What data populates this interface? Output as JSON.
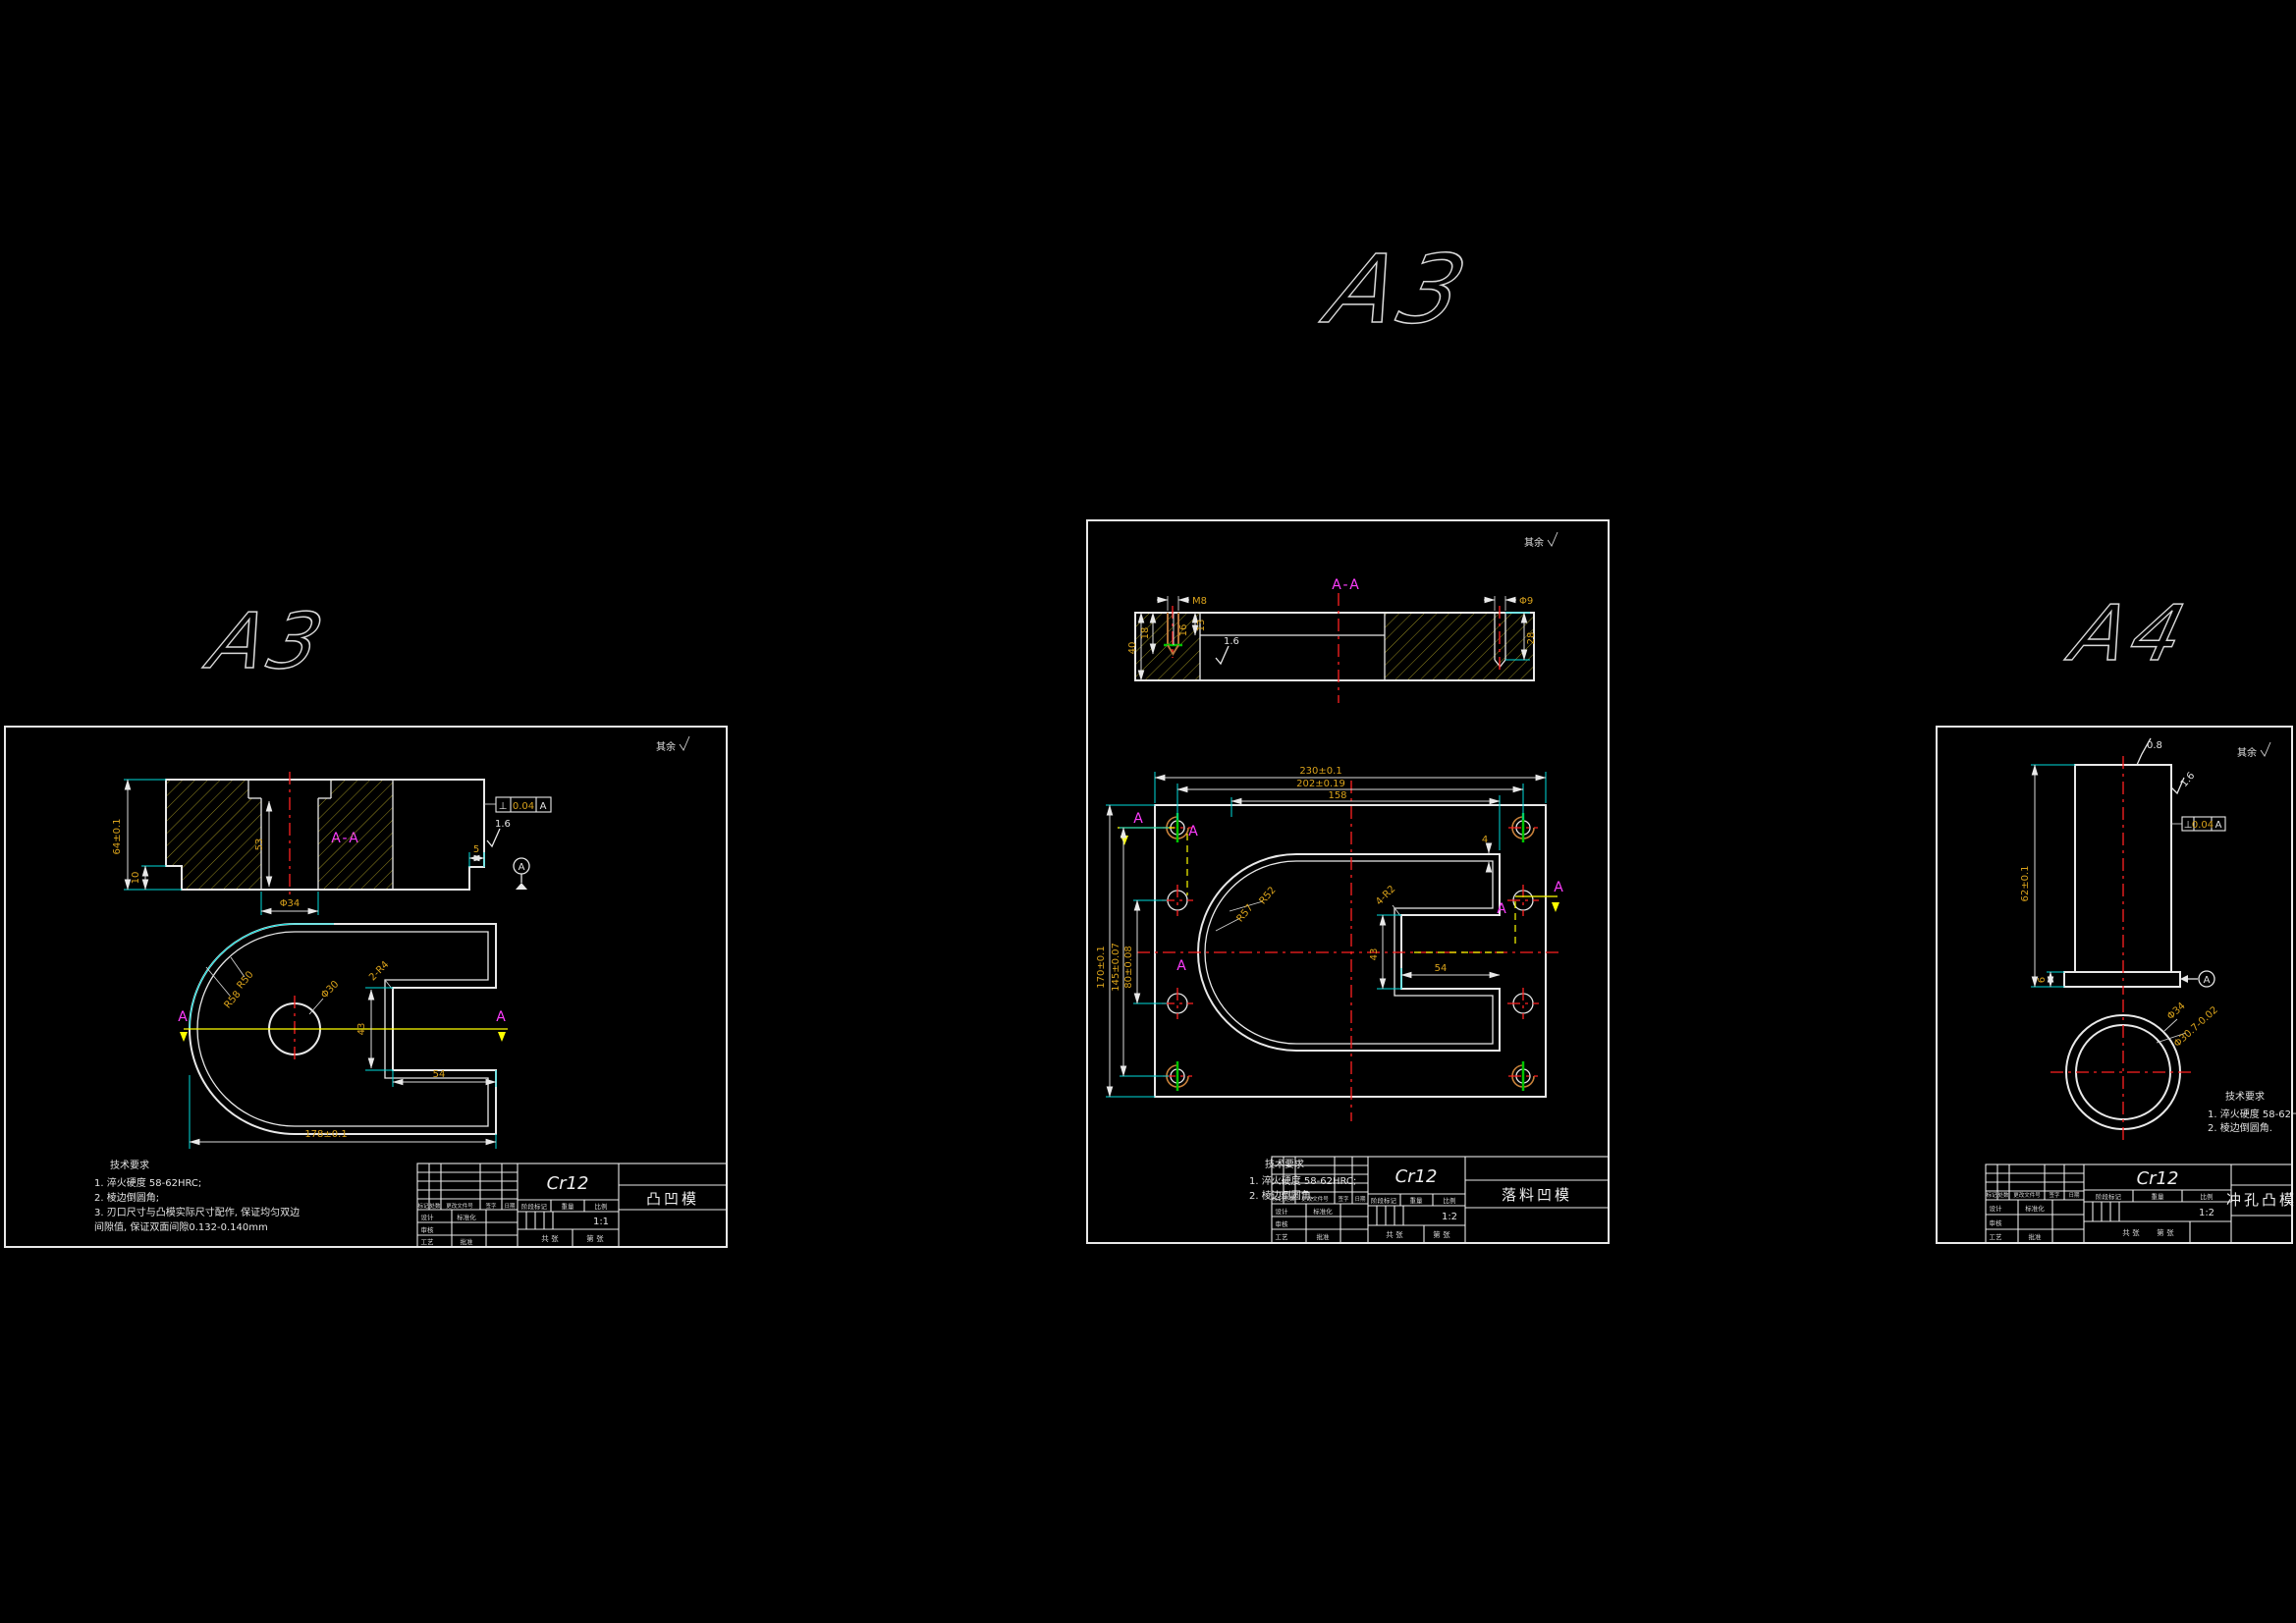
{
  "canvas": {
    "background": "#000000"
  },
  "tb_labels": {
    "mark": "标记",
    "count": "处数",
    "zone": "分区",
    "change": "更改文件号",
    "sign": "签字",
    "date": "日期",
    "design": "设计",
    "draw": "制图",
    "check": "审核",
    "process": "工艺",
    "approve": "批准",
    "std": "标准化",
    "stage": "阶段标记",
    "weight": "重量",
    "scale": "比例",
    "total": "共 张",
    "page": "第 张"
  },
  "sheet1": {
    "size_label": "A3",
    "corner_note": "其余",
    "section_label": "A-A",
    "section_marker": "A",
    "dims": {
      "height": "64±0.1",
      "step_left": "10",
      "hole_depth": "53",
      "hole_dia": "Φ34",
      "step_right": "5",
      "perp_symbol": "⊥",
      "perp_tol": "0.04",
      "perp_datum": "A",
      "roughness": "1.6",
      "datum": "A",
      "r_inner": "R50",
      "r_outer": "R58",
      "center_hole": "Φ30",
      "notch_r": "2-R4",
      "slot_width": "43",
      "slot_length": "54",
      "overall_width": "178±0.1"
    },
    "tech_req": {
      "title": "技术要求",
      "lines": [
        "1. 淬火硬度 58-62HRC;",
        "2. 棱边倒圆角;",
        "3. 刃口尺寸与凸模实际尺寸配作, 保证均匀双边",
        "间隙值, 保证双面间隙0.132-0.140mm"
      ]
    },
    "title_block": {
      "material": "Cr12",
      "part_name": "凸凹模",
      "scale": "1:1"
    }
  },
  "sheet2": {
    "size_label": "A3",
    "corner_note": "其余",
    "section_label": "A-A",
    "section_marker": "A",
    "dims": {
      "thread": "M8",
      "plate_thick": "40",
      "hole_depth": "18",
      "thread_depth": "16",
      "land": "13",
      "roughness": "1.6",
      "hole_dia": "Φ9",
      "hole_depth2": "28",
      "width_overall": "230±0.1",
      "width_holes": "202±0.19",
      "width_inner": "158",
      "height_overall": "170±0.1",
      "height_holes": "145±0.07",
      "height_inner": "80±0.08",
      "r_inner": "R52",
      "r_outer": "R57",
      "notch_r": "4-R2",
      "slot_width": "43",
      "slot_length": "54",
      "edge": "4"
    },
    "tech_req": {
      "title": "技术要求",
      "lines": [
        "1. 淬火硬度 58-62HRC;",
        "2. 棱边倒圆角."
      ]
    },
    "title_block": {
      "material": "Cr12",
      "part_name": "落料凹模",
      "scale": "1:2"
    }
  },
  "sheet3": {
    "size_label": "A4",
    "corner_note": "其余",
    "dims": {
      "height": "62±0.1",
      "flange": "6",
      "rough_top": "0.8",
      "rough_side": "1.6",
      "perp_symbol": "⊥",
      "perp_tol": "0.04",
      "perp_datum": "A",
      "datum": "A",
      "outer_dia": "Φ34",
      "inner_dia": "Φ30.7-0.02"
    },
    "tech_req": {
      "title": "技术要求",
      "lines": [
        "1. 淬火硬度 58-62HRC;",
        "2. 棱边倒圆角."
      ]
    },
    "title_block": {
      "material": "Cr12",
      "part_name": "冲孔凸模",
      "scale": "1:2"
    }
  }
}
